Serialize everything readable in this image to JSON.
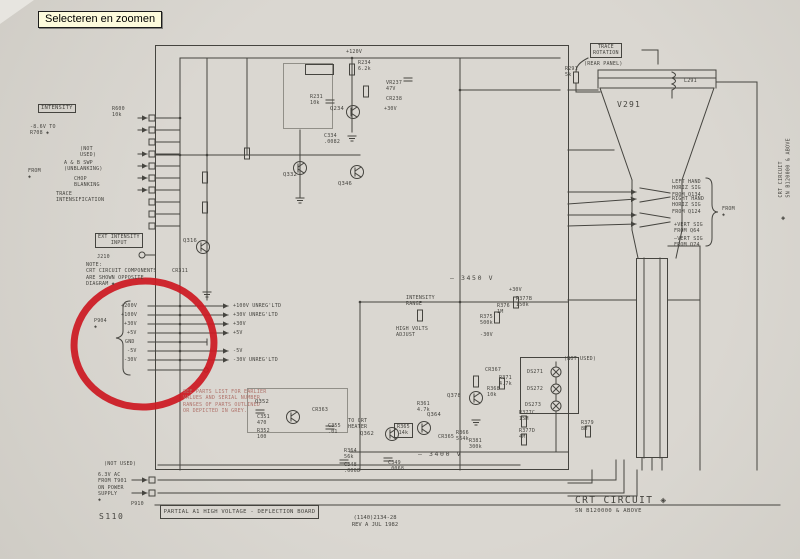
{
  "ui": {
    "zoom_button_label": "Selecteren en zoomen"
  },
  "colors": {
    "ink": "#45443f",
    "grey": "#918f88",
    "red": "#cc1a22",
    "note_red": "#b0736b",
    "paper": "#d8d5cf",
    "tooltip": "#fdfbdc"
  },
  "title_block": {
    "title": "CRT CIRCUIT ◈",
    "serial": "SN B120000 & ABOVE"
  },
  "footer": {
    "board_banner": "PARTIAL A1 HIGH VOLTAGE - DEFLECTION BOARD",
    "doc_number": "(1140)2134-28",
    "revision": "REV A JUL 1982",
    "page_code": "S110"
  },
  "side_tab": {
    "text": "CRT CIRCUIT\nSN B120000 & ABOVE",
    "diamond": "◈"
  },
  "schematic": {
    "labels": [
      {
        "t": "INTENSITY",
        "x": 38,
        "y": 104,
        "c": "boxed",
        "n": "intensity-control-label"
      },
      {
        "t": "R600\n10k",
        "x": 112,
        "y": 106,
        "c": "xs"
      },
      {
        "t": "-8.6V TO\nR708 ◈",
        "x": 30,
        "y": 124,
        "c": "xs"
      },
      {
        "t": "(NOT\nUSED)",
        "x": 80,
        "y": 146,
        "c": "xs"
      },
      {
        "t": "A & B SWP\n(UNBLANKING)",
        "x": 64,
        "y": 160,
        "c": "xs"
      },
      {
        "t": "CHOP\nBLANKING",
        "x": 74,
        "y": 176,
        "c": "xs"
      },
      {
        "t": "TRACE\nINTENSIFICATION",
        "x": 56,
        "y": 191,
        "c": "xs"
      },
      {
        "t": "FROM\n◈",
        "x": 28,
        "y": 168,
        "c": "xs"
      },
      {
        "t": "EXT INTENSITY\nINPUT",
        "x": 95,
        "y": 233,
        "c": "boxed xs",
        "n": "ext-intensity-input-label"
      },
      {
        "t": "J210",
        "x": 97,
        "y": 254,
        "c": "xs"
      },
      {
        "t": "NOTE:\nCRT CIRCUIT COMPONENTS\nARE SHOWN OPPOSITE\nDIAGRAM ◈",
        "x": 86,
        "y": 262,
        "c": "xs",
        "n": "crt-note"
      },
      {
        "t": "CR311",
        "x": 172,
        "y": 268,
        "c": "xs"
      },
      {
        "t": "Q316",
        "x": 183,
        "y": 238
      },
      {
        "t": "P904\n◈",
        "x": 94,
        "y": 318,
        "c": "xs",
        "n": "connector-p904-label"
      },
      {
        "t": "+200V",
        "x": 121,
        "y": 303,
        "c": "xs"
      },
      {
        "t": "+100V",
        "x": 121,
        "y": 312,
        "c": "xs"
      },
      {
        "t": "+30V",
        "x": 124,
        "y": 321,
        "c": "xs"
      },
      {
        "t": "+5V",
        "x": 127,
        "y": 330,
        "c": "xs"
      },
      {
        "t": "GND",
        "x": 125,
        "y": 339,
        "c": "xs"
      },
      {
        "t": "-5V",
        "x": 127,
        "y": 348,
        "c": "xs"
      },
      {
        "t": "-30V",
        "x": 124,
        "y": 357,
        "c": "xs"
      },
      {
        "t": "+100V UNREG'LTD",
        "x": 233,
        "y": 303,
        "c": "xs"
      },
      {
        "t": "+30V UNREG'LTD",
        "x": 233,
        "y": 312,
        "c": "xs"
      },
      {
        "t": "+30V",
        "x": 233,
        "y": 321,
        "c": "xs"
      },
      {
        "t": "+5V",
        "x": 233,
        "y": 330,
        "c": "xs"
      },
      {
        "t": "-5V",
        "x": 233,
        "y": 348,
        "c": "xs"
      },
      {
        "t": "-30V UNREG'LTD",
        "x": 233,
        "y": 357,
        "c": "xs"
      },
      {
        "t": "SEE PARTS LIST FOR EARLIER\nVALUES AND SERIAL NUMBER\nRANGES OF PARTS OUTLINED\nOR DEPICTED IN GREY.",
        "x": 183,
        "y": 389,
        "c": "xs red",
        "n": "parts-list-note"
      },
      {
        "t": "+120V",
        "x": 346,
        "y": 49,
        "c": "xs"
      },
      {
        "t": "R234\n6.2k",
        "x": 358,
        "y": 60,
        "c": "xs"
      },
      {
        "t": "Q234",
        "x": 330,
        "y": 106
      },
      {
        "t": "VR237\n47V",
        "x": 386,
        "y": 80,
        "c": "xs"
      },
      {
        "t": "CR238",
        "x": 386,
        "y": 96,
        "c": "xs"
      },
      {
        "t": "+30V",
        "x": 384,
        "y": 106,
        "c": "xs"
      },
      {
        "t": "R231\n10k",
        "x": 310,
        "y": 94,
        "c": "xs"
      },
      {
        "t": "Q332",
        "x": 283,
        "y": 172
      },
      {
        "t": "Q346",
        "x": 338,
        "y": 181
      },
      {
        "t": "C334\n.0082",
        "x": 324,
        "y": 133,
        "c": "xs"
      },
      {
        "t": "– 3450 V",
        "x": 450,
        "y": 274,
        "c": "rail",
        "n": "cathode-voltage-label"
      },
      {
        "t": "INTENSITY\nRANGE",
        "x": 406,
        "y": 295,
        "c": "xs"
      },
      {
        "t": "HIGH VOLTS\nADJUST",
        "x": 396,
        "y": 326,
        "c": "xs"
      },
      {
        "t": "R375\n500k",
        "x": 480,
        "y": 314,
        "c": "xs"
      },
      {
        "t": "R376\n1M",
        "x": 497,
        "y": 303,
        "c": "xs"
      },
      {
        "t": "R377B\n150k",
        "x": 516,
        "y": 296,
        "c": "xs"
      },
      {
        "t": "+30V",
        "x": 509,
        "y": 287,
        "c": "xs"
      },
      {
        "t": "-30V",
        "x": 480,
        "y": 332,
        "c": "xs"
      },
      {
        "t": "Q352",
        "x": 255,
        "y": 399
      },
      {
        "t": "C351\n470",
        "x": 257,
        "y": 414,
        "c": "xs"
      },
      {
        "t": "R352\n100",
        "x": 257,
        "y": 428,
        "c": "xs"
      },
      {
        "t": "CR363",
        "x": 312,
        "y": 407,
        "c": "xs"
      },
      {
        "t": "C355\n.01",
        "x": 328,
        "y": 423,
        "c": "xs"
      },
      {
        "t": "TO CRT\nHEATER",
        "x": 348,
        "y": 418,
        "c": "xs"
      },
      {
        "t": "R361\n4.7k",
        "x": 417,
        "y": 401,
        "c": "xs"
      },
      {
        "t": "Q362",
        "x": 360,
        "y": 431
      },
      {
        "t": "R365\n14k",
        "x": 394,
        "y": 423,
        "c": "xs boxed"
      },
      {
        "t": "Q364",
        "x": 427,
        "y": 412
      },
      {
        "t": "CR365",
        "x": 438,
        "y": 434,
        "c": "xs"
      },
      {
        "t": "R366\n564k",
        "x": 456,
        "y": 430,
        "c": "xs"
      },
      {
        "t": "R364\n56k",
        "x": 344,
        "y": 448,
        "c": "xs"
      },
      {
        "t": "C348\n.0068",
        "x": 344,
        "y": 462,
        "c": "xs"
      },
      {
        "t": "C349\n.0068",
        "x": 388,
        "y": 460,
        "c": "xs"
      },
      {
        "t": "– 3400 V",
        "x": 418,
        "y": 450,
        "c": "rail"
      },
      {
        "t": "Q378",
        "x": 447,
        "y": 393
      },
      {
        "t": "CR367",
        "x": 485,
        "y": 367,
        "c": "xs"
      },
      {
        "t": "R371\n4.7k",
        "x": 499,
        "y": 375,
        "c": "xs"
      },
      {
        "t": "R368\n10k",
        "x": 487,
        "y": 386,
        "c": "xs"
      },
      {
        "t": "DS271",
        "x": 527,
        "y": 369,
        "c": "xs"
      },
      {
        "t": "DS272",
        "x": 527,
        "y": 386,
        "c": "xs"
      },
      {
        "t": "DS273",
        "x": 525,
        "y": 402,
        "c": "xs"
      },
      {
        "t": "(NOT USED)",
        "x": 564,
        "y": 356,
        "c": "xs"
      },
      {
        "t": "R377C\n15M",
        "x": 519,
        "y": 410,
        "c": "xs"
      },
      {
        "t": "R377D\n4M",
        "x": 519,
        "y": 428,
        "c": "xs"
      },
      {
        "t": "R379\n8M",
        "x": 581,
        "y": 420,
        "c": "xs"
      },
      {
        "t": "R381\n300k",
        "x": 469,
        "y": 438,
        "c": "xs"
      },
      {
        "t": "V291",
        "x": 617,
        "y": 100,
        "c": "tube",
        "n": "crt-tube-label"
      },
      {
        "t": "L291",
        "x": 684,
        "y": 78,
        "c": "xs"
      },
      {
        "t": "R291\n5k",
        "x": 565,
        "y": 66,
        "c": "xs"
      },
      {
        "t": "TRACE\nROTATION",
        "x": 590,
        "y": 43,
        "c": "boxed xs",
        "n": "trace-rotation-label"
      },
      {
        "t": "(REAR PANEL)",
        "x": 584,
        "y": 61,
        "c": "xs"
      },
      {
        "t": "LEFT HAND\nHORIZ SIG\nFROM Q134",
        "x": 672,
        "y": 179,
        "c": "xs"
      },
      {
        "t": "RIGHT HAND\nHORIZ SIG\nFROM Q124",
        "x": 672,
        "y": 196,
        "c": "xs"
      },
      {
        "t": "FROM\n◈",
        "x": 722,
        "y": 206,
        "c": "xs"
      },
      {
        "t": "+VERT SIG\nFROM Q64",
        "x": 674,
        "y": 222,
        "c": "xs"
      },
      {
        "t": "–VERT SIG\nFROM Q74",
        "x": 674,
        "y": 236,
        "c": "xs"
      },
      {
        "t": "(NOT USED)",
        "x": 104,
        "y": 461,
        "c": "xs"
      },
      {
        "t": "6.3V AC\nFROM T901\nON POWER\nSUPPLY\n◈",
        "x": 98,
        "y": 472,
        "c": "xs"
      },
      {
        "t": "P910",
        "x": 131,
        "y": 501,
        "c": "xs",
        "n": "connector-p910-label"
      }
    ]
  }
}
